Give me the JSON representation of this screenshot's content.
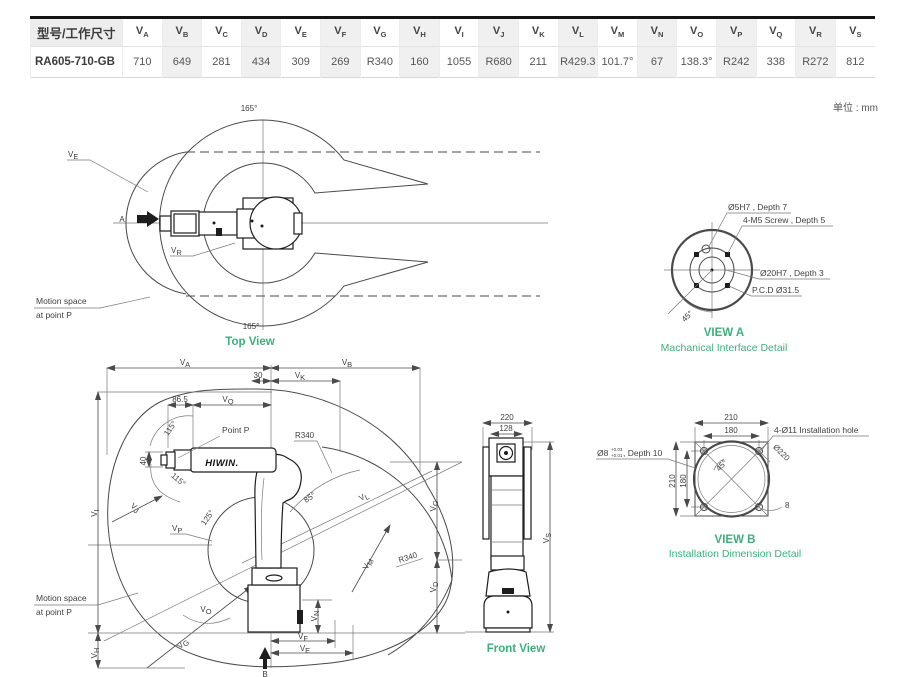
{
  "unit_note": "单位 : mm",
  "colors": {
    "accent_green": "#3fae7d",
    "line": "#4a4a4a",
    "stripe": "#f0f0f0"
  },
  "table": {
    "header_col": "型号/工作尺寸",
    "columns": [
      {
        "base": "V",
        "sub": "A"
      },
      {
        "base": "V",
        "sub": "B"
      },
      {
        "base": "V",
        "sub": "C"
      },
      {
        "base": "V",
        "sub": "D"
      },
      {
        "base": "V",
        "sub": "E"
      },
      {
        "base": "V",
        "sub": "F"
      },
      {
        "base": "V",
        "sub": "G"
      },
      {
        "base": "V",
        "sub": "H"
      },
      {
        "base": "V",
        "sub": "I"
      },
      {
        "base": "V",
        "sub": "J"
      },
      {
        "base": "V",
        "sub": "K"
      },
      {
        "base": "V",
        "sub": "L"
      },
      {
        "base": "V",
        "sub": "M"
      },
      {
        "base": "V",
        "sub": "N"
      },
      {
        "base": "V",
        "sub": "O"
      },
      {
        "base": "V",
        "sub": "P"
      },
      {
        "base": "V",
        "sub": "Q"
      },
      {
        "base": "V",
        "sub": "R"
      },
      {
        "base": "V",
        "sub": "S"
      }
    ],
    "model": "RA605-710-GB",
    "values": [
      "710",
      "649",
      "281",
      "434",
      "309",
      "269",
      "R340",
      "160",
      "1055",
      "R680",
      "211",
      "R429.3",
      "101.7°",
      "67",
      "138.3°",
      "R242",
      "338",
      "R272",
      "812"
    ]
  },
  "top_view": {
    "title": "Top View",
    "angle_top": "165°",
    "angle_bottom": "165°",
    "ve": {
      "base": "V",
      "sub": "E"
    },
    "vr": {
      "base": "V",
      "sub": "R"
    },
    "a": "A",
    "motion1": "Motion space",
    "motion2": "at point P"
  },
  "view_a": {
    "title": "VIEW A",
    "subtitle": "Machanical Interface Detail",
    "c1": "Ø5H7 , Depth 7",
    "c2": "4-M5 Screw , Depth 5",
    "c3": "Ø20H7 , Depth 3",
    "c4": "P.C.D Ø31.5",
    "a45": "45°"
  },
  "side_view": {
    "labels": {
      "va": {
        "base": "V",
        "sub": "A"
      },
      "vb": {
        "base": "V",
        "sub": "B"
      },
      "vc": {
        "base": "V",
        "sub": "C"
      },
      "vd": {
        "base": "V",
        "sub": "D"
      },
      "ve": {
        "base": "V",
        "sub": "E"
      },
      "vf": {
        "base": "V",
        "sub": "F"
      },
      "vg": {
        "base": "V",
        "sub": "G"
      },
      "vh": {
        "base": "V",
        "sub": "H"
      },
      "vi": {
        "base": "V",
        "sub": "I"
      },
      "vj": {
        "base": "V",
        "sub": "J"
      },
      "vk": {
        "base": "V",
        "sub": "K"
      },
      "vl": {
        "base": "V",
        "sub": "L"
      },
      "vm": {
        "base": "V",
        "sub": "M"
      },
      "vn": {
        "base": "V",
        "sub": "N"
      },
      "vo": {
        "base": "V",
        "sub": "O"
      },
      "vp": {
        "base": "V",
        "sub": "P"
      },
      "vq": {
        "base": "V",
        "sub": "Q"
      }
    },
    "d30": "30",
    "d86": "86.5",
    "d40": "40",
    "a115_top": "115°",
    "a115_bottom": "115°",
    "a125": "125°",
    "a85": "85°",
    "r340_top": "R340",
    "r340_bottom": "R340",
    "point_p": "Point P",
    "b": "B",
    "logo": "HIWIN.",
    "motion1": "Motion space",
    "motion2": "at point P"
  },
  "front_view": {
    "title": "Front View",
    "d220": "220",
    "d128": "128",
    "vs": {
      "base": "V",
      "sub": "S"
    }
  },
  "view_b": {
    "title": "VIEW B",
    "subtitle": "Installation Dimension Detail",
    "d210_top": "210",
    "d180_top": "180",
    "d210_left": "210",
    "d180_left": "180",
    "hole": "4-Ø11 Installation hole",
    "dia220": "Ø220",
    "a45": "45°",
    "r8": "8",
    "pin": "Ø8",
    "pin_tol_top": "+0.03",
    "pin_tol_bot": "+0.01",
    "pin_suffix": ", Depth 10"
  }
}
